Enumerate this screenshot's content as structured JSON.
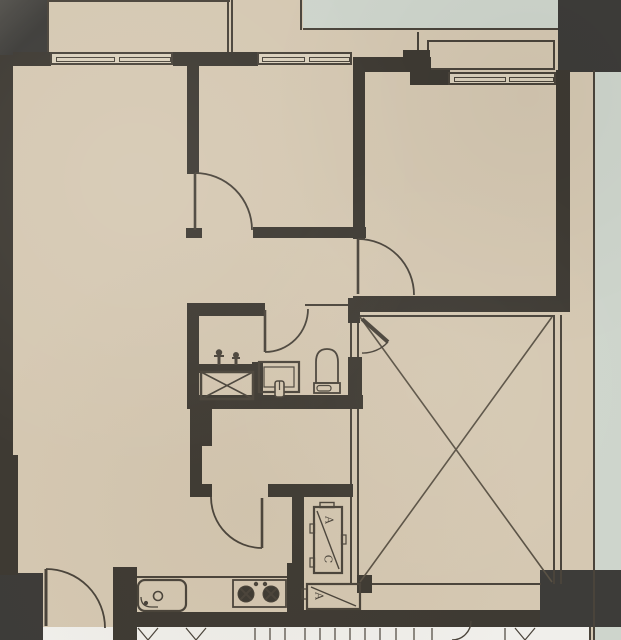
{
  "plan": {
    "labels": {
      "ac_top": "A",
      "ac_bottom": "C",
      "ac_box": "A"
    },
    "colors": {
      "floor": "#d5c8b2",
      "wall": "#3e3a33",
      "outside": "#3d3c39",
      "pale": "#ced5cc",
      "white": "#f0efeb",
      "line": "#4a443b",
      "win": "#dbd1bd",
      "xline": "#5a5245"
    }
  }
}
